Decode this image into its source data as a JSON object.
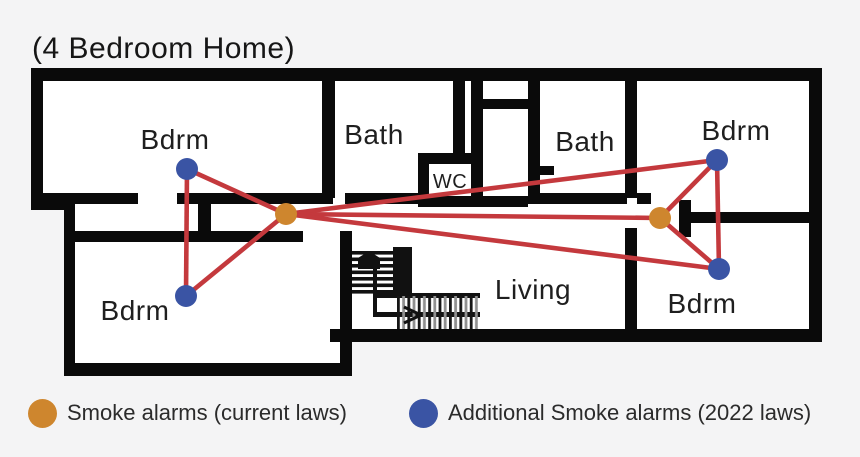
{
  "title": "(4 Bedroom Home)",
  "rooms": {
    "bdrm_tl": "Bdrm",
    "bath_left": "Bath",
    "wc": "WC",
    "bath_right": "Bath",
    "bdrm_tr": "Bdrm",
    "bdrm_bl": "Bdrm",
    "living": "Living",
    "bdrm_br": "Bdrm"
  },
  "legend": {
    "current": {
      "label": "Smoke alarms (current laws)",
      "color": "#CE862E"
    },
    "additional": {
      "label": "Additional Smoke alarms (2022 laws)",
      "color": "#3A54A4"
    }
  },
  "colors": {
    "alarm_current": "#CE862E",
    "alarm_additional": "#3A54A4",
    "coverage_line": "#C4393D",
    "wall": "#0A0A0A",
    "floor": "#FFFFFF",
    "background": "#F4F4F5"
  }
}
